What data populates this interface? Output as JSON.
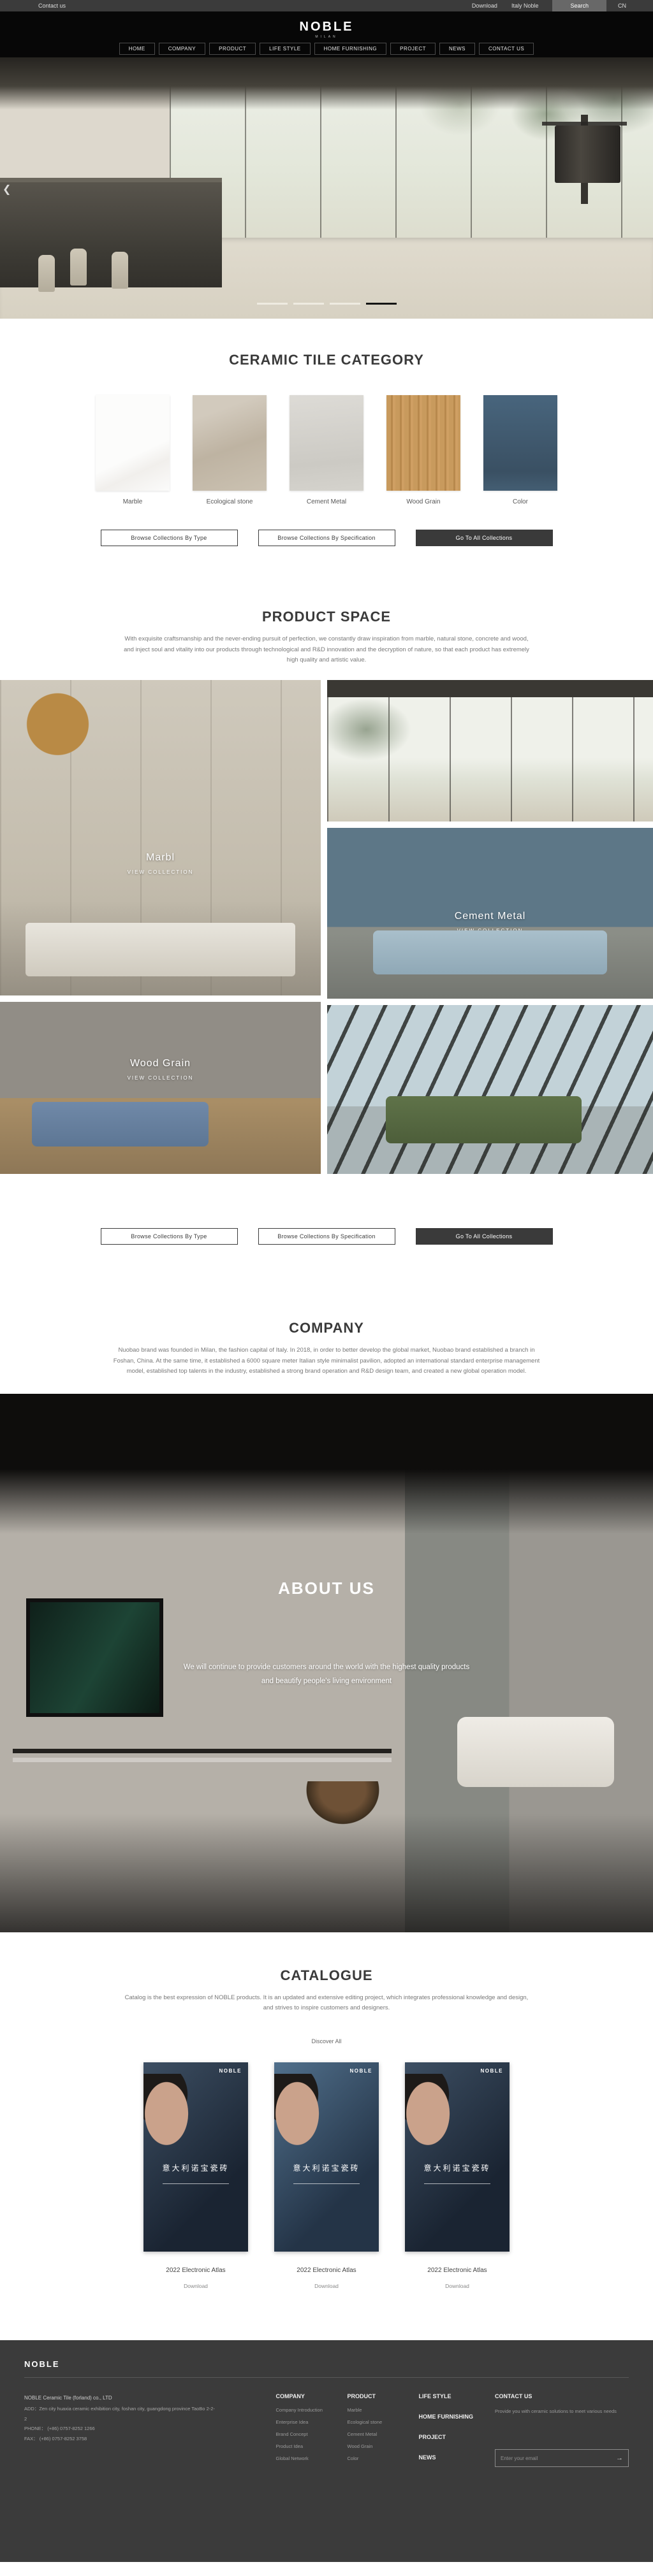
{
  "topbar": {
    "contact": "Contact us",
    "download": "Download",
    "italy": "Italy Noble",
    "search": "Search",
    "lang": "CN"
  },
  "header": {
    "logo": "NOBLE",
    "logo_sub": "MILAN",
    "nav": [
      {
        "label": "HOME"
      },
      {
        "label": "COMPANY"
      },
      {
        "label": "PRODUCT"
      },
      {
        "label": "LIFE STYLE"
      },
      {
        "label": "HOME FURNISHING"
      },
      {
        "label": "PROJECT"
      },
      {
        "label": "NEWS"
      },
      {
        "label": "CONTACT US"
      }
    ]
  },
  "hero": {
    "prev_arrow": "❮",
    "slide_count": 4,
    "active_slide": 4
  },
  "collection_buttons": [
    {
      "label": "Browse Collections By Type",
      "style": "outline"
    },
    {
      "label": "Browse Collections By Specification",
      "style": "outline"
    },
    {
      "label": "Go To All Collections",
      "style": "dark"
    }
  ],
  "category": {
    "title": "CERAMIC TILE CATEGORY",
    "items": [
      {
        "label": "Marble",
        "color": "#fafaf9"
      },
      {
        "label": "Ecological stone",
        "color": "#c4baab"
      },
      {
        "label": "Cement Metal",
        "color": "#d5d3cd"
      },
      {
        "label": "Wood Grain",
        "color": "#c2945a"
      },
      {
        "label": "Color",
        "color": "#3f586c"
      }
    ]
  },
  "product_space": {
    "title": "PRODUCT SPACE",
    "description": "With exquisite craftsmanship and the never-ending pursuit of perfection, we constantly draw inspiration from marble, natural stone, concrete and wood, and inject soul and vitality into our products through technological and R&D innovation and the decryption of nature, so that each product has extremely high quality and artistic value.",
    "gallery": [
      {
        "label": "Marbl",
        "sub": "VIEW COLLECTION"
      },
      {},
      {
        "label": "Cement Metal",
        "sub": "VIEW COLLECTION"
      },
      {
        "label": "Wood Grain",
        "sub": "VIEW COLLECTION"
      },
      {}
    ]
  },
  "company": {
    "title": "COMPANY",
    "description": "Nuobao brand was founded in Milan, the fashion capital of Italy. In 2018, in order to better develop the global market, Nuobao brand established a branch in Foshan, China. At the same time, it established a 6000 square meter Italian style minimalist pavilion, adopted an international standard enterprise management model, established top talents in the industry, established a strong brand operation and R&D design team, and created a new global operation model."
  },
  "about": {
    "title": "ABOUT US",
    "line1": "We will continue to provide customers around the world with the highest quality products",
    "line2": "and beautify people's living environment"
  },
  "catalogue": {
    "title": "CATALOGUE",
    "description": "Catalog is the best expression of NOBLE products. It is an updated and extensive editing project, which integrates professional knowledge and design, and strives to inspire customers and designers.",
    "discover": "Discover All",
    "cover_brand": "NOBLE",
    "cover_cjk": "意大利诺宝瓷砖",
    "items": [
      {
        "title": "2022 Electronic Atlas",
        "download": "Download"
      },
      {
        "title": "2022 Electronic Atlas",
        "download": "Download"
      },
      {
        "title": "2022 Electronic Atlas",
        "download": "Download"
      }
    ]
  },
  "footer": {
    "logo": "NOBLE",
    "company_name": "NOBLE Ceramic Tile (forland) co., LTD",
    "address": "ADD：Zen city huaxia ceramic exhibition city, foshan city, guangdong province TaoBo 2-2-2",
    "phone": "PHONE：  (+86)  0757-8252 1266",
    "fax": "FAX：  (+86)  0757-8252 3758",
    "col_company": {
      "head": "COMPANY",
      "links": [
        {
          "label": "Company Introduction"
        },
        {
          "label": "Enterprise Idea"
        },
        {
          "label": "Brand Concept"
        },
        {
          "label": "Product Idea"
        },
        {
          "label": "Global Network"
        }
      ]
    },
    "col_product": {
      "head": "PRODUCT",
      "links": [
        {
          "label": "Marble"
        },
        {
          "label": "Ecological stone"
        },
        {
          "label": "Cement Metal"
        },
        {
          "label": "Wood Grain"
        },
        {
          "label": "Color"
        }
      ]
    },
    "col_stack": [
      {
        "label": "LIFE STYLE"
      },
      {
        "label": "HOME FURNISHING"
      },
      {
        "label": "PROJECT"
      },
      {
        "label": "NEWS"
      }
    ],
    "col_contact": {
      "head": "CONTACT US",
      "text": "Provide you with ceramic solutions to meet various needs",
      "email_placeholder": "Enter your email",
      "submit_arrow": "→"
    }
  },
  "colors": {
    "topbar_bg": "#3b3b3b",
    "header_bg": "#070707",
    "dark_button": "#3a3a3a",
    "footer_bg": "#3b3b3b",
    "active_dash": "#141414"
  }
}
